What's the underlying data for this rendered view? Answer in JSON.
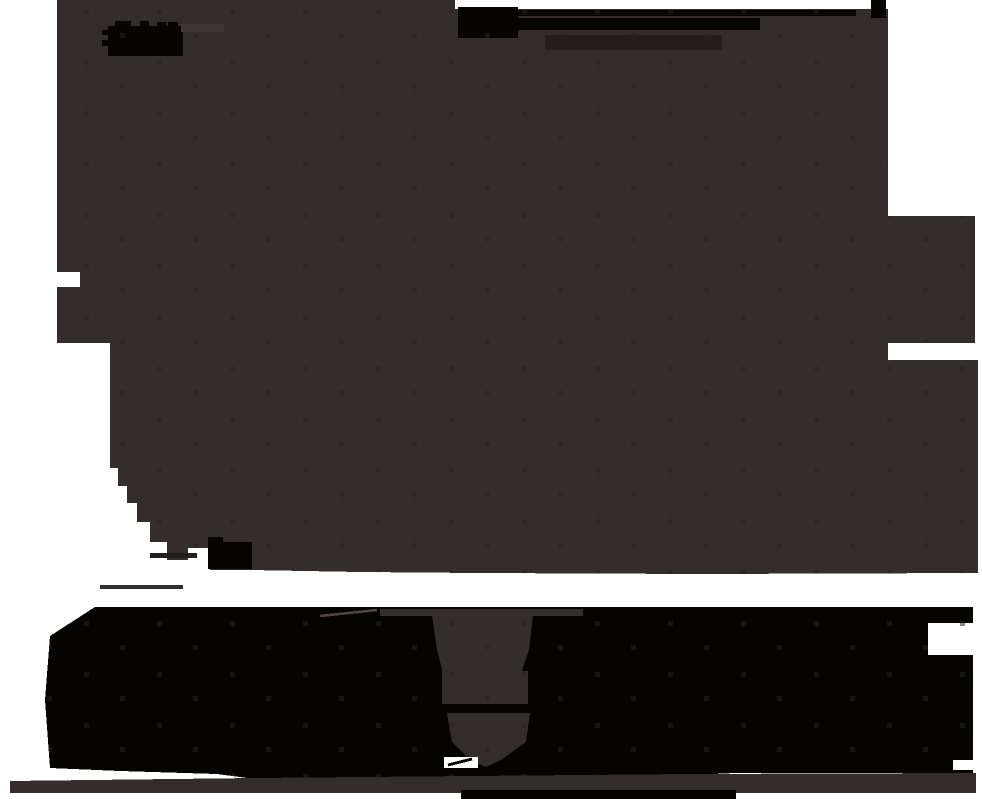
{
  "canvas": {
    "width_px": 982,
    "height_px": 799
  },
  "colors": {
    "background": "#ffffff",
    "silhouette": "#332d2d",
    "silhouette_light": "#3d3737",
    "ink_black": "#070404",
    "band_black": "#060303",
    "bar_muted": "#241f1f",
    "speckle": "#282222",
    "scratch": "#4e4646"
  }
}
